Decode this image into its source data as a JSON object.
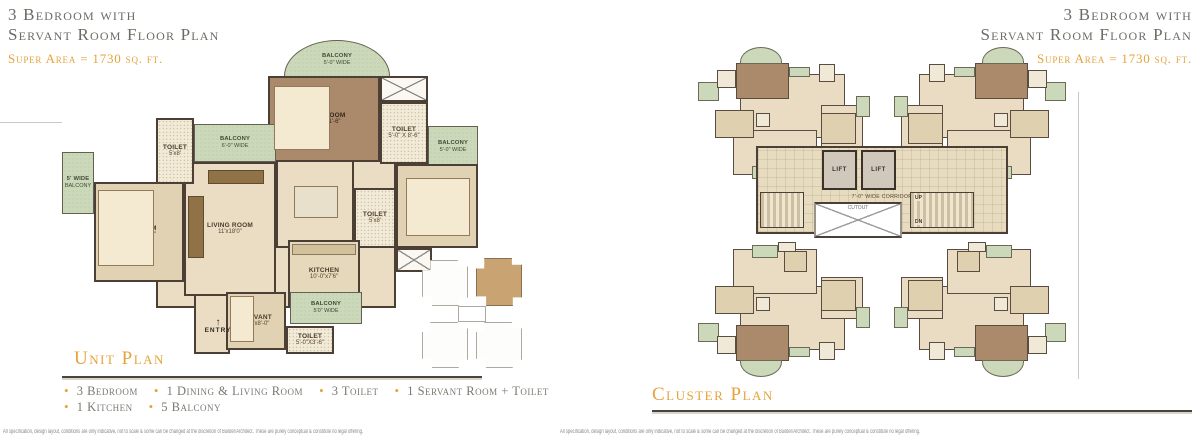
{
  "colors": {
    "gold": "#E5A33C",
    "heading": "#6E6A64",
    "wall": "#4B3F36",
    "floor": "#EADDC4",
    "floor-dark": "#E0D2B2",
    "master": "#AB8A6C",
    "balcony": "#CBD8BA",
    "toilet": "#F2EAD8",
    "features": "#7C7872",
    "rule": "#4A443C"
  },
  "header": {
    "title_line1": "3 Bedroom with",
    "title_line2": "Servant Room Floor Plan",
    "super_area": "Super Area = 1730 sq. ft."
  },
  "unit_plan": {
    "section_title": "Unit Plan",
    "entry_label": "ENTRY",
    "entry_arrow": "↑",
    "rooms": [
      {
        "id": "hall-core",
        "type": "hall",
        "x": 94,
        "y": 118,
        "w": 240,
        "h": 150
      },
      {
        "id": "entry-hall",
        "type": "hall",
        "x": 132,
        "y": 240,
        "w": 36,
        "h": 74
      },
      {
        "id": "balcony-top",
        "type": "balcony",
        "label": "BALCONY",
        "dims": "5'-0\" WIDE",
        "x": 222,
        "y": 0,
        "w": 106,
        "h": 40,
        "round": "50% 50% 0 0 / 90% 90% 0 0"
      },
      {
        "id": "master-bedroom",
        "type": "master",
        "label": "M.BEDROOM",
        "dims": "14'-0\"x11'-6\"",
        "x": 206,
        "y": 36,
        "w": 112,
        "h": 86
      },
      {
        "id": "shaft-top",
        "type": "shaft",
        "x": 318,
        "y": 36,
        "w": 48,
        "h": 26
      },
      {
        "id": "toilet-master",
        "type": "toilet",
        "label": "TOILET",
        "dims": "5'-0\" X 8'-6\"",
        "x": 318,
        "y": 62,
        "w": 48,
        "h": 62
      },
      {
        "id": "balcony-right",
        "type": "balcony",
        "label": "BALCONY",
        "dims": "5'-0\" WIDE",
        "x": 366,
        "y": 86,
        "w": 50,
        "h": 42
      },
      {
        "id": "bedroom-right",
        "type": "room-dark",
        "label": "BEDROOM",
        "dims": "11'x11'6\"",
        "x": 334,
        "y": 124,
        "w": 82,
        "h": 84
      },
      {
        "id": "toilet-mid",
        "type": "toilet",
        "label": "TOILET",
        "dims": "5'x8'",
        "x": 292,
        "y": 148,
        "w": 42,
        "h": 60
      },
      {
        "id": "shaft-bottom",
        "type": "shaft",
        "x": 334,
        "y": 208,
        "w": 36,
        "h": 24
      },
      {
        "id": "dining",
        "type": "room",
        "label": "DINING",
        "dims": "10'-5\"x10'0\"",
        "x": 214,
        "y": 120,
        "w": 78,
        "h": 88
      },
      {
        "id": "living-room",
        "type": "room",
        "label": "LIVING ROOM",
        "dims": "11'x18'0\"",
        "x": 122,
        "y": 122,
        "w": 92,
        "h": 134
      },
      {
        "id": "balcony-upper-left",
        "type": "balcony",
        "label": "BALCONY",
        "dims": "6'-0\" WIDE",
        "x": 132,
        "y": 84,
        "w": 82,
        "h": 38
      },
      {
        "id": "toilet-upper-left",
        "type": "toilet",
        "label": "TOILET",
        "dims": "5'x8'",
        "x": 94,
        "y": 78,
        "w": 38,
        "h": 66
      },
      {
        "id": "balcony-left",
        "type": "balcony",
        "label": "5' WIDE",
        "dims": "BALCONY",
        "x": 0,
        "y": 112,
        "w": 32,
        "h": 62
      },
      {
        "id": "bedroom-left",
        "type": "room-dark",
        "label": "BEDROOM",
        "dims": "11'-0\"X12'-0\"",
        "x": 32,
        "y": 142,
        "w": 90,
        "h": 100
      },
      {
        "id": "kitchen",
        "type": "kitchen",
        "label": "KITCHEN",
        "dims": "10'-0\"x7'6\"",
        "x": 226,
        "y": 200,
        "w": 72,
        "h": 68
      },
      {
        "id": "servant-room",
        "type": "room-dark",
        "label": "SERVANT",
        "dims": "6'-4\"x8'-0\"",
        "x": 164,
        "y": 252,
        "w": 60,
        "h": 58
      },
      {
        "id": "balcony-bottom",
        "type": "balcony",
        "label": "BALCONY",
        "dims": "5'0\" WIDE",
        "x": 228,
        "y": 252,
        "w": 72,
        "h": 32
      },
      {
        "id": "toilet-bottom",
        "type": "toilet",
        "label": "TOILET",
        "dims": "5'-0\"X3'-6\"",
        "x": 224,
        "y": 286,
        "w": 48,
        "h": 28
      }
    ],
    "furniture": [
      {
        "t": "bed",
        "x": 212,
        "y": 46,
        "w": 56,
        "h": 64
      },
      {
        "t": "bed",
        "x": 344,
        "y": 138,
        "w": 64,
        "h": 58
      },
      {
        "t": "bed",
        "x": 36,
        "y": 150,
        "w": 56,
        "h": 76
      },
      {
        "t": "bed",
        "x": 168,
        "y": 256,
        "w": 24,
        "h": 46
      },
      {
        "t": "table",
        "x": 232,
        "y": 146,
        "w": 44,
        "h": 32
      },
      {
        "t": "sofa",
        "x": 126,
        "y": 156,
        "w": 16,
        "h": 62
      },
      {
        "t": "sofa",
        "x": 146,
        "y": 130,
        "w": 56,
        "h": 14
      },
      {
        "t": "counter",
        "x": 230,
        "y": 204,
        "w": 64,
        "h": 11
      }
    ]
  },
  "features": {
    "lines": [
      [
        "3 Bedroom",
        "1 Dining & Living Room",
        "3 Toilet",
        "1 Servant Room + Toilet"
      ],
      [
        "1 Kitchen",
        "5 Balcony"
      ]
    ]
  },
  "key_plan": {
    "wings": [
      {
        "id": "top-left",
        "x": 2,
        "y": 4,
        "w": 46,
        "h": 46,
        "hl": false
      },
      {
        "id": "top-right",
        "x": 56,
        "y": 2,
        "w": 46,
        "h": 48,
        "hl": true
      },
      {
        "id": "bottom-left",
        "x": 2,
        "y": 66,
        "w": 46,
        "h": 46,
        "hl": false
      },
      {
        "id": "bottom-right",
        "x": 56,
        "y": 66,
        "w": 46,
        "h": 46,
        "hl": false
      },
      {
        "id": "center",
        "x": 38,
        "y": 50,
        "w": 28,
        "h": 16,
        "hl": false,
        "center": true
      }
    ]
  },
  "cluster_plan": {
    "section_title": "Cluster Plan",
    "core": {
      "lift_label": "LIFT",
      "corridor_label": "7'-0\" WIDE CORRIDOR",
      "cutout_label": "CUTOUT",
      "up_label": "UP",
      "dn_label": "DN"
    },
    "wings": [
      {
        "id": "top-left",
        "x": 4,
        "y": 0,
        "flip": "scaleX(-1)"
      },
      {
        "id": "top-right",
        "x": 204,
        "y": 0,
        "flip": "none"
      },
      {
        "id": "bottom-left",
        "x": 4,
        "y": 192,
        "flip": "scale(-1,-1)"
      },
      {
        "id": "bottom-right",
        "x": 204,
        "y": 192,
        "flip": "scaleY(-1)"
      }
    ],
    "unit_blocks": [
      {
        "t": "room",
        "x": 14,
        "y": 20,
        "w": 60,
        "h": 46
      },
      {
        "t": "room",
        "x": 4,
        "y": 42,
        "w": 24,
        "h": 30
      },
      {
        "t": "room",
        "x": 30,
        "y": 60,
        "w": 48,
        "h": 32
      },
      {
        "t": "dark",
        "x": 8,
        "y": 48,
        "w": 20,
        "h": 22
      },
      {
        "t": "dark",
        "x": 66,
        "y": 46,
        "w": 22,
        "h": 20
      },
      {
        "t": "dark",
        "x": 36,
        "y": 76,
        "w": 13,
        "h": 15
      },
      {
        "t": "master",
        "x": 46,
        "y": 12,
        "w": 30,
        "h": 26
      },
      {
        "t": "balc",
        "x": 50,
        "y": 1,
        "w": 24,
        "h": 12,
        "round": true
      },
      {
        "t": "balc",
        "x": 34,
        "y": 15,
        "w": 12,
        "h": 7
      },
      {
        "t": "balc",
        "x": 0,
        "y": 36,
        "w": 8,
        "h": 15
      },
      {
        "t": "balc",
        "x": 86,
        "y": 26,
        "w": 12,
        "h": 13
      },
      {
        "t": "balc",
        "x": 52,
        "y": 86,
        "w": 15,
        "h": 9
      },
      {
        "t": "toil",
        "x": 76,
        "y": 17,
        "w": 11,
        "h": 13
      },
      {
        "t": "toil",
        "x": 20,
        "y": 13,
        "w": 9,
        "h": 13
      },
      {
        "t": "toil",
        "x": 57,
        "y": 48,
        "w": 8,
        "h": 10
      },
      {
        "t": "toil",
        "x": 42,
        "y": 90,
        "w": 10,
        "h": 7
      }
    ]
  },
  "footer": {
    "disclaimer": "All specification, design layout, conditions are only indicative, not to scale & some can be changed at the discretion of Builder/Architect. These are purely conceptual & constitute no legal offering."
  }
}
